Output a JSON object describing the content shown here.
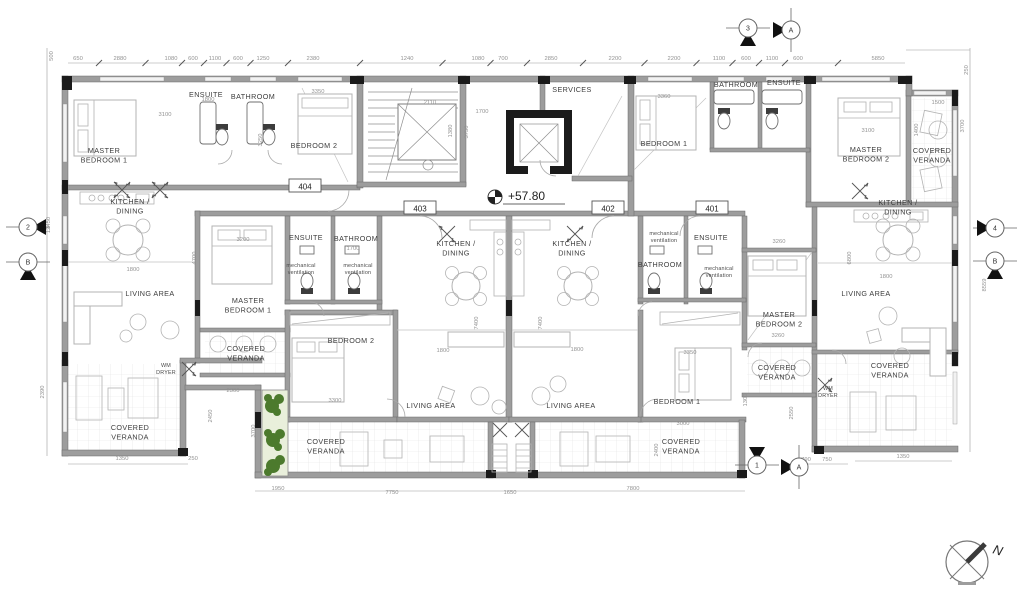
{
  "drawing": {
    "type": "architectural-floor-plan",
    "elevation": {
      "label": "+57.80"
    },
    "north": {
      "label": "N"
    },
    "apartment_tags": [
      {
        "label": "404",
        "x": 305,
        "y": 187
      },
      {
        "label": "403",
        "x": 420,
        "y": 209
      },
      {
        "label": "402",
        "x": 608,
        "y": 209
      },
      {
        "label": "401",
        "x": 712,
        "y": 209
      }
    ],
    "room_labels": [
      {
        "lines": [
          "MASTER",
          "BEDROOM 1"
        ],
        "x": 104,
        "y": 153
      },
      {
        "lines": [
          "ENSUITE"
        ],
        "x": 206,
        "y": 97
      },
      {
        "lines": [
          "BATHROOM"
        ],
        "x": 253,
        "y": 99
      },
      {
        "lines": [
          "BEDROOM 2"
        ],
        "x": 314,
        "y": 148
      },
      {
        "lines": [
          "KITCHEN /",
          "DINING"
        ],
        "x": 130,
        "y": 204
      },
      {
        "lines": [
          "LIVING AREA"
        ],
        "x": 150,
        "y": 296
      },
      {
        "lines": [
          "SERVICES"
        ],
        "x": 572,
        "y": 92
      },
      {
        "lines": [
          "BEDROOM 1"
        ],
        "x": 664,
        "y": 146
      },
      {
        "lines": [
          "BATHROOM"
        ],
        "x": 736,
        "y": 87
      },
      {
        "lines": [
          "ENSUITE"
        ],
        "x": 784,
        "y": 85
      },
      {
        "lines": [
          "MASTER",
          "BEDROOM 2"
        ],
        "x": 866,
        "y": 152
      },
      {
        "lines": [
          "COVERED",
          "VERANDA"
        ],
        "x": 932,
        "y": 153
      },
      {
        "lines": [
          "KITCHEN /",
          "DINING"
        ],
        "x": 898,
        "y": 205
      },
      {
        "lines": [
          "LIVING AREA"
        ],
        "x": 866,
        "y": 296
      },
      {
        "lines": [
          "MASTER",
          "BEDROOM 1"
        ],
        "x": 248,
        "y": 303
      },
      {
        "lines": [
          "ENSUITE"
        ],
        "x": 306,
        "y": 240
      },
      {
        "lines": [
          "BATHROOM"
        ],
        "x": 356,
        "y": 241
      },
      {
        "lines": [
          "KITCHEN /",
          "DINING"
        ],
        "x": 456,
        "y": 246
      },
      {
        "lines": [
          "BEDROOM 2"
        ],
        "x": 351,
        "y": 343
      },
      {
        "lines": [
          "LIVING AREA"
        ],
        "x": 431,
        "y": 408
      },
      {
        "lines": [
          "KITCHEN /",
          "DINING"
        ],
        "x": 572,
        "y": 246
      },
      {
        "lines": [
          "ENSUITE"
        ],
        "x": 711,
        "y": 240
      },
      {
        "lines": [
          "BATHROOM"
        ],
        "x": 660,
        "y": 267
      },
      {
        "lines": [
          "MASTER",
          "BEDROOM 2"
        ],
        "x": 779,
        "y": 317
      },
      {
        "lines": [
          "BEDROOM 1"
        ],
        "x": 677,
        "y": 404
      },
      {
        "lines": [
          "LIVING AREA"
        ],
        "x": 571,
        "y": 408
      },
      {
        "lines": [
          "COVERED",
          "VERANDA"
        ],
        "x": 246,
        "y": 351
      },
      {
        "lines": [
          "COVERED",
          "VERANDA"
        ],
        "x": 130,
        "y": 430
      },
      {
        "lines": [
          "COVERED",
          "VERANDA"
        ],
        "x": 326,
        "y": 444
      },
      {
        "lines": [
          "COVERED",
          "VERANDA"
        ],
        "x": 681,
        "y": 444
      },
      {
        "lines": [
          "COVERED",
          "VERANDA"
        ],
        "x": 777,
        "y": 370
      },
      {
        "lines": [
          "COVERED",
          "VERANDA"
        ],
        "x": 890,
        "y": 368
      }
    ],
    "small_labels": [
      {
        "lines": [
          "mechanical",
          "ventilation"
        ],
        "x": 301,
        "y": 267
      },
      {
        "lines": [
          "mechanical",
          "ventilation"
        ],
        "x": 358,
        "y": 267
      },
      {
        "lines": [
          "mechanical",
          "ventilation"
        ],
        "x": 664,
        "y": 235
      },
      {
        "lines": [
          "mechanical",
          "ventilation"
        ],
        "x": 719,
        "y": 270
      },
      {
        "lines": [
          "WM",
          "DRYER"
        ],
        "x": 166,
        "y": 367
      },
      {
        "lines": [
          "WM",
          "DRYER"
        ],
        "x": 828,
        "y": 390
      }
    ],
    "dimensions": {
      "top": [
        {
          "t": "650",
          "x": 78,
          "y": 60
        },
        {
          "t": "2880",
          "x": 120,
          "y": 60
        },
        {
          "t": "1080",
          "x": 171,
          "y": 60
        },
        {
          "t": "600",
          "x": 193,
          "y": 60
        },
        {
          "t": "1100",
          "x": 215,
          "y": 60
        },
        {
          "t": "600",
          "x": 238,
          "y": 60
        },
        {
          "t": "1250",
          "x": 263,
          "y": 60
        },
        {
          "t": "2380",
          "x": 313,
          "y": 60
        },
        {
          "t": "1240",
          "x": 407,
          "y": 60
        },
        {
          "t": "1080",
          "x": 478,
          "y": 60
        },
        {
          "t": "700",
          "x": 503,
          "y": 60
        },
        {
          "t": "2850",
          "x": 551,
          "y": 60
        },
        {
          "t": "2200",
          "x": 615,
          "y": 60
        },
        {
          "t": "2200",
          "x": 674,
          "y": 60
        },
        {
          "t": "1100",
          "x": 719,
          "y": 60
        },
        {
          "t": "600",
          "x": 746,
          "y": 60
        },
        {
          "t": "1100",
          "x": 772,
          "y": 60
        },
        {
          "t": "600",
          "x": 798,
          "y": 60
        },
        {
          "t": "5850",
          "x": 878,
          "y": 60
        }
      ],
      "bottom": [
        {
          "t": "1350",
          "x": 122,
          "y": 460
        },
        {
          "t": "250",
          "x": 193,
          "y": 460
        },
        {
          "t": "1950",
          "x": 278,
          "y": 490
        },
        {
          "t": "7750",
          "x": 392,
          "y": 494
        },
        {
          "t": "1650",
          "x": 510,
          "y": 494
        },
        {
          "t": "7800",
          "x": 633,
          "y": 490
        },
        {
          "t": "790",
          "x": 806,
          "y": 461
        },
        {
          "t": "750",
          "x": 827,
          "y": 461
        },
        {
          "t": "1350",
          "x": 903,
          "y": 458
        }
      ],
      "left": [
        {
          "t": "500",
          "x": 53,
          "y": 56,
          "r": -90
        },
        {
          "t": "12450",
          "x": 50,
          "y": 225,
          "r": -90
        },
        {
          "t": "2390",
          "x": 44,
          "y": 392,
          "r": -90
        }
      ],
      "right": [
        {
          "t": "250",
          "x": 968,
          "y": 70,
          "r": -90
        },
        {
          "t": "3700",
          "x": 964,
          "y": 126,
          "r": -90
        },
        {
          "t": "8559",
          "x": 986,
          "y": 285,
          "r": -90
        }
      ],
      "interior": [
        {
          "t": "3100",
          "x": 165,
          "y": 116
        },
        {
          "t": "3250",
          "x": 262,
          "y": 140,
          "r": -90
        },
        {
          "t": "3350",
          "x": 318,
          "y": 93
        },
        {
          "t": "1800",
          "x": 208,
          "y": 101
        },
        {
          "t": "2110",
          "x": 430,
          "y": 104
        },
        {
          "t": "1380",
          "x": 452,
          "y": 131,
          "r": -90
        },
        {
          "t": "1700",
          "x": 482,
          "y": 113
        },
        {
          "t": "3750",
          "x": 468,
          "y": 132,
          "r": -90
        },
        {
          "t": "3360",
          "x": 664,
          "y": 98
        },
        {
          "t": "3100",
          "x": 868,
          "y": 132
        },
        {
          "t": "1500",
          "x": 938,
          "y": 104
        },
        {
          "t": "1400",
          "x": 918,
          "y": 130,
          "r": -90
        },
        {
          "t": "3200",
          "x": 243,
          "y": 241
        },
        {
          "t": "1800",
          "x": 133,
          "y": 271
        },
        {
          "t": "4700",
          "x": 196,
          "y": 258,
          "r": -90
        },
        {
          "t": "1700",
          "x": 353,
          "y": 250
        },
        {
          "t": "1800",
          "x": 443,
          "y": 352
        },
        {
          "t": "7400",
          "x": 478,
          "y": 323,
          "r": -90
        },
        {
          "t": "3300",
          "x": 335,
          "y": 402
        },
        {
          "t": "1800",
          "x": 577,
          "y": 351
        },
        {
          "t": "7400",
          "x": 542,
          "y": 323,
          "r": -90
        },
        {
          "t": "3350",
          "x": 690,
          "y": 354
        },
        {
          "t": "3000",
          "x": 683,
          "y": 425
        },
        {
          "t": "3260",
          "x": 779,
          "y": 243
        },
        {
          "t": "3260",
          "x": 778,
          "y": 337
        },
        {
          "t": "1800",
          "x": 886,
          "y": 278
        },
        {
          "t": "6800",
          "x": 851,
          "y": 258,
          "r": -90
        },
        {
          "t": "2300",
          "x": 233,
          "y": 392
        },
        {
          "t": "2450",
          "x": 212,
          "y": 416,
          "r": -90
        },
        {
          "t": "3700",
          "x": 255,
          "y": 431,
          "r": -90
        },
        {
          "t": "2400",
          "x": 658,
          "y": 450,
          "r": -90
        },
        {
          "t": "2550",
          "x": 793,
          "y": 413,
          "r": -90
        },
        {
          "t": "1300",
          "x": 747,
          "y": 400,
          "r": -90
        }
      ]
    },
    "section_markers": [
      {
        "label": "2",
        "x": 28,
        "y": 227,
        "tri": "right",
        "line": "h"
      },
      {
        "label": "B",
        "x": 28,
        "y": 262,
        "tri": "down",
        "line": "h"
      },
      {
        "label": "3",
        "x": 748,
        "y": 28,
        "tri": "down",
        "line": "h"
      },
      {
        "label": "A",
        "x": 791,
        "y": 30,
        "tri": "left",
        "line": "v"
      },
      {
        "label": "4",
        "x": 995,
        "y": 228,
        "tri": "left",
        "line": "h"
      },
      {
        "label": "B",
        "x": 995,
        "y": 261,
        "tri": "down",
        "line": "h"
      },
      {
        "label": "1",
        "x": 757,
        "y": 465,
        "tri": "up",
        "line": "h"
      },
      {
        "label": "A",
        "x": 799,
        "y": 467,
        "tri": "left",
        "line": "v"
      }
    ],
    "colors": {
      "wall": "#9d9d9d",
      "column": "#1b1b1b",
      "room_text": "#3c3c3c",
      "dim_text": "#929292",
      "plant": "#4c7a2d",
      "planter_bg": "#e9efdb"
    }
  }
}
